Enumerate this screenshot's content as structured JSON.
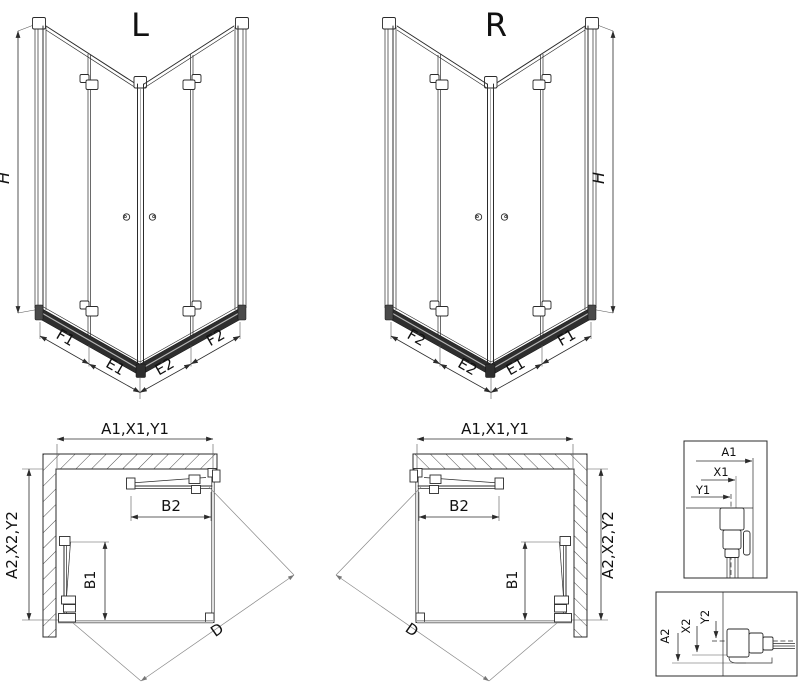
{
  "iso_left": {
    "variant": "L",
    "height": "H",
    "seg_f1": "F1",
    "seg_e1": "E1",
    "seg_e2": "E2",
    "seg_f2": "F2"
  },
  "iso_right": {
    "variant": "R",
    "height": "H",
    "seg_f2": "F2",
    "seg_e2": "E2",
    "seg_e1": "E1",
    "seg_f1": "F1"
  },
  "plan_left": {
    "width": "A1,X1,Y1",
    "depth": "A2,X2,Y2",
    "door_top": "B2",
    "door_side": "B1",
    "diagonal": "D"
  },
  "plan_right": {
    "width": "A1,X1,Y1",
    "depth": "A2,X2,Y2",
    "door_top": "B2",
    "door_side": "B1",
    "diagonal": "D"
  },
  "detail_top": {
    "a1": "A1",
    "x1": "X1",
    "y1": "Y1"
  },
  "detail_bottom": {
    "a2": "A2",
    "x2": "X2",
    "y2": "Y2"
  },
  "colors": {
    "line": "#2b2b2b",
    "rail": "#2e2e2e",
    "rail_highlight": "#b5b5b5",
    "tray_gray": "#999999",
    "hatch": "#3a3a3a",
    "background": "#ffffff"
  }
}
